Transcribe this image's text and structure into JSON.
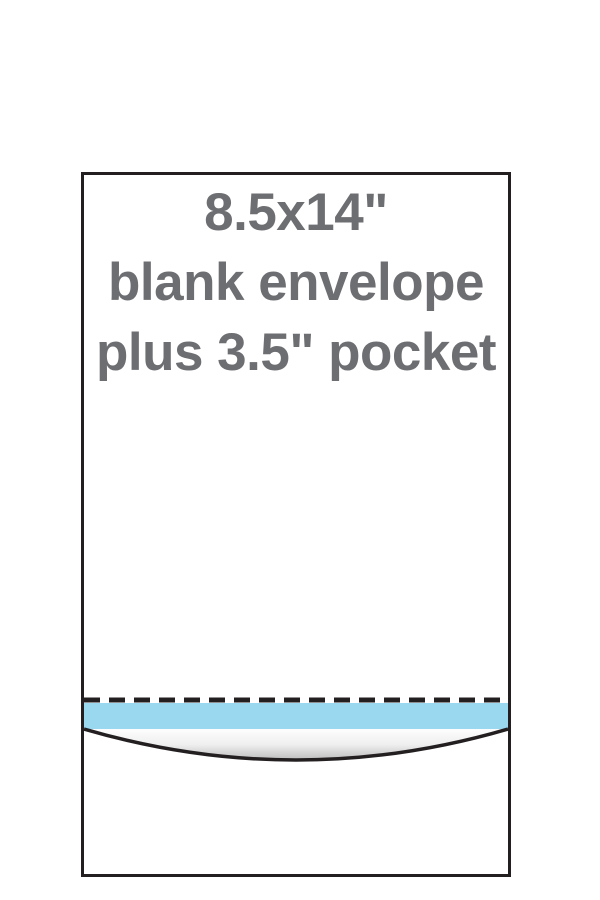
{
  "diagram": {
    "title": "envelope pocket diagram",
    "label_lines": {
      "0": "8.5x14\"",
      "1": "blank envelope",
      "2": "plus 3.5\" pocket"
    },
    "dimensions": {
      "envelope_size": "8.5x14\"",
      "pocket_depth": "3.5\""
    },
    "colors": {
      "outline": "#231f20",
      "adhesive_strip": "#99d8ef",
      "label_text": "#6d6e71",
      "shade_top": "#ffffff",
      "shade_mid": "#efefef",
      "shade_bottom": "#c0c0c0",
      "background": "#ffffff"
    }
  }
}
